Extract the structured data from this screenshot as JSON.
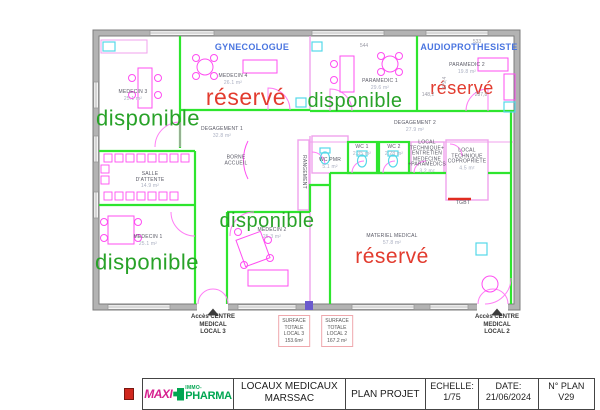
{
  "plan": {
    "status_labels": [
      {
        "name": "status-medecin-3",
        "text": "disponible",
        "color": "#28a228",
        "x": 148,
        "y": 119,
        "size": 22
      },
      {
        "name": "status-medecin-4",
        "text": "réservé",
        "color": "#e23b2e",
        "x": 246,
        "y": 98,
        "size": 23
      },
      {
        "name": "status-paramedic-1",
        "text": "disponible",
        "color": "#28a228",
        "x": 355,
        "y": 101,
        "size": 20
      },
      {
        "name": "status-paramedic-2",
        "text": "réservé",
        "color": "#e23b2e",
        "x": 462,
        "y": 88,
        "size": 18
      },
      {
        "name": "status-medecin-2",
        "text": "disponible",
        "color": "#28a228",
        "x": 267,
        "y": 221,
        "size": 20
      },
      {
        "name": "status-medecin-1",
        "text": "disponible",
        "color": "#28a228",
        "x": 147,
        "y": 263,
        "size": 22
      },
      {
        "name": "status-materiel-medical",
        "text": "réservé",
        "color": "#e23b2e",
        "x": 392,
        "y": 257,
        "size": 21
      }
    ],
    "specialty_labels": [
      {
        "name": "label-gynecologue",
        "text": "GYNECOLOGUE",
        "color": "#4a75e0",
        "x": 252,
        "y": 47
      },
      {
        "name": "label-audioprothesiste",
        "text": "AUDIOPROTHESISTE",
        "color": "#4a75e0",
        "x": 469,
        "y": 47
      }
    ],
    "rooms": [
      {
        "name": "room-medecin-3",
        "label": "MEDECIN 3",
        "area": "25.1 m²",
        "x": 133,
        "y": 96
      },
      {
        "name": "room-medecin-4",
        "label": "MEDECIN 4",
        "area": "26.1 m²",
        "x": 233,
        "y": 80
      },
      {
        "name": "room-paramedic-1",
        "label": "PARAMEDIC 1",
        "area": "29.6 m²",
        "x": 380,
        "y": 85
      },
      {
        "name": "room-paramedic-2",
        "label": "PARAMEDIC 2",
        "area": "19.8 m²",
        "x": 467,
        "y": 69
      },
      {
        "name": "room-degagement-1",
        "label": "DEGAGEMENT 1",
        "area": "32.8 m²",
        "x": 222,
        "y": 133
      },
      {
        "name": "room-degagement-2",
        "label": "DEGAGEMENT 2",
        "area": "27.9 m²",
        "x": 415,
        "y": 127
      },
      {
        "name": "room-borne-accueil",
        "label": "BORNE\nACCUEIL",
        "area": "",
        "x": 236,
        "y": 161
      },
      {
        "name": "room-salle-attente",
        "label": "SALLE\nD'ATTENTE",
        "area": "14.9 m²",
        "x": 150,
        "y": 181
      },
      {
        "name": "room-medecin-1",
        "label": "MEDECIN 1",
        "area": "25.1 m²",
        "x": 148,
        "y": 241
      },
      {
        "name": "room-medecin-2",
        "label": "MEDECIN 2",
        "area": "25.3 m²",
        "x": 272,
        "y": 234
      },
      {
        "name": "room-wc-pmr",
        "label": "WC PMR",
        "area": "5.1 m²",
        "x": 330,
        "y": 164
      },
      {
        "name": "room-wc-1",
        "label": "WC 1",
        "area": "2.35 m²",
        "x": 362,
        "y": 151
      },
      {
        "name": "room-wc-2",
        "label": "WC 2",
        "area": "2.28 m²",
        "x": 394,
        "y": 151
      },
      {
        "name": "room-local-technique-entretien",
        "label": "LOCAL\nTECHNIQUE+\nENTRETIEN\nMEDECINE\n+PARAMEDICS",
        "area": "3.2 m²",
        "x": 427,
        "y": 158
      },
      {
        "name": "room-local-technique-copropriete",
        "label": "LOCAL\nTECHNIQUE\nCOPROPRIETE",
        "area": "4.5 m²",
        "x": 467,
        "y": 160
      },
      {
        "name": "room-materiel-medical",
        "label": "MATERIEL MEDICAL",
        "area": "57.8 m²",
        "x": 392,
        "y": 240
      },
      {
        "name": "room-rangement",
        "label": "RANGEMENT",
        "area": "",
        "x": 303,
        "y": 172,
        "vertical": true
      },
      {
        "name": "label-tgbt",
        "label": "TGBT",
        "area": "",
        "x": 463,
        "y": 204
      }
    ],
    "dimensions": [
      {
        "name": "dim-544",
        "text": "544",
        "x": 364,
        "y": 47
      },
      {
        "name": "dim-533",
        "text": "533",
        "x": 477,
        "y": 43
      },
      {
        "name": "dim-148-2",
        "text": "148,2",
        "x": 428,
        "y": 96
      },
      {
        "name": "dim-287-8",
        "text": "287,8",
        "x": 481,
        "y": 96
      },
      {
        "name": "dim-379-4",
        "text": "379,4",
        "x": 446,
        "y": 83,
        "rotate": true
      }
    ],
    "access_labels": [
      {
        "name": "access-local-3",
        "text": "Accès CENTRE\nMEDICAL\nLOCAL 3",
        "x": 213,
        "y": 325
      },
      {
        "name": "access-local-2",
        "text": "Accès CENTRE\nMEDICAL\nLOCAL 2",
        "x": 497,
        "y": 325
      }
    ],
    "surface_boxes": [
      {
        "name": "surface-totale-local-3",
        "lines": [
          "SURFACE",
          "TOTALE",
          "LOCAL 3",
          "153.6m²"
        ],
        "x": 294,
        "y": 331
      },
      {
        "name": "surface-totale-local-2",
        "lines": [
          "SURFACE",
          "TOTALE",
          "LOCAL 2",
          "167.2 m²"
        ],
        "x": 337,
        "y": 331
      }
    ]
  },
  "title_block": {
    "logo_maxi": "MAXI",
    "logo_immo": "IMMO-",
    "logo_pharma": "PHARMA",
    "project": "LOCAUX MEDICAUX\nMARSSAC",
    "doc": "PLAN PROJET",
    "scale_label": "ECHELLE:",
    "scale_value": "1/75",
    "date_label": "DATE:",
    "date_value": "21/06/2024",
    "plan_label": "N° PLAN",
    "plan_value": "V29"
  }
}
